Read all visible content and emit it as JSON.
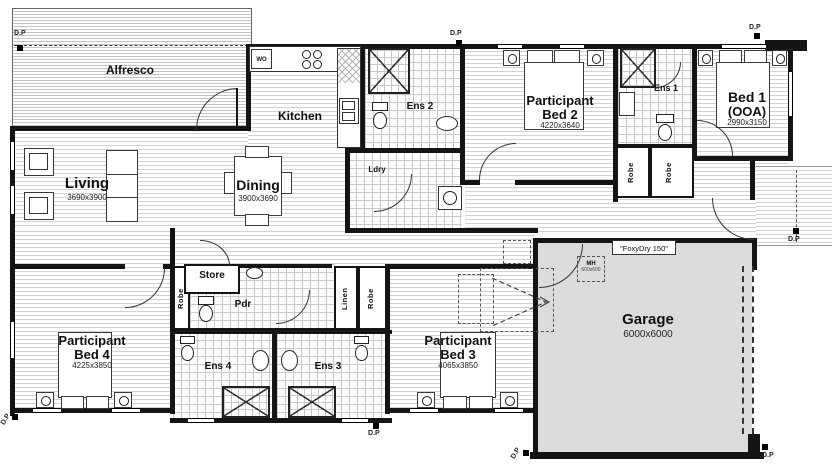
{
  "rooms": {
    "alfresco": {
      "label": "Alfresco"
    },
    "kitchen": {
      "label": "Kitchen"
    },
    "living": {
      "label": "Living",
      "dim": "3690x3900"
    },
    "dining": {
      "label": "Dining",
      "dim": "3900x3690"
    },
    "ldry": {
      "label": "Ldry"
    },
    "ens2": {
      "label": "Ens 2"
    },
    "bed2": {
      "line1": "Participant",
      "line2": "Bed 2",
      "dim": "4220x3640"
    },
    "ens1": {
      "label": "Ens 1"
    },
    "bed1": {
      "line1": "Bed 1",
      "line2": "(OOA)",
      "dim": "2990x3150"
    },
    "store": {
      "label": "Store"
    },
    "pdr": {
      "label": "Pdr"
    },
    "linen": {
      "label": "Linen"
    },
    "robe": {
      "label": "Robe"
    },
    "ens4": {
      "label": "Ens 4"
    },
    "ens3": {
      "label": "Ens 3"
    },
    "bed4": {
      "line1": "Participant",
      "line2": "Bed 4",
      "dim": "4225x3850"
    },
    "bed3": {
      "line1": "Participant",
      "line2": "Bed 3",
      "dim": "4065x3850"
    },
    "garage": {
      "label": "Garage",
      "dim": "6000x6000"
    }
  },
  "annotations": {
    "foxydry": "\"FoxyDry 150\"",
    "mh": "MH",
    "mh_dim": "600x600",
    "dp": "D.P",
    "wo": "WO"
  },
  "colors": {
    "wall": "#141414",
    "stripe": "#d2d2d2",
    "tile_line": "#c9c9c9",
    "garage_fill": "#dcdcdc",
    "background": "#ffffff"
  }
}
